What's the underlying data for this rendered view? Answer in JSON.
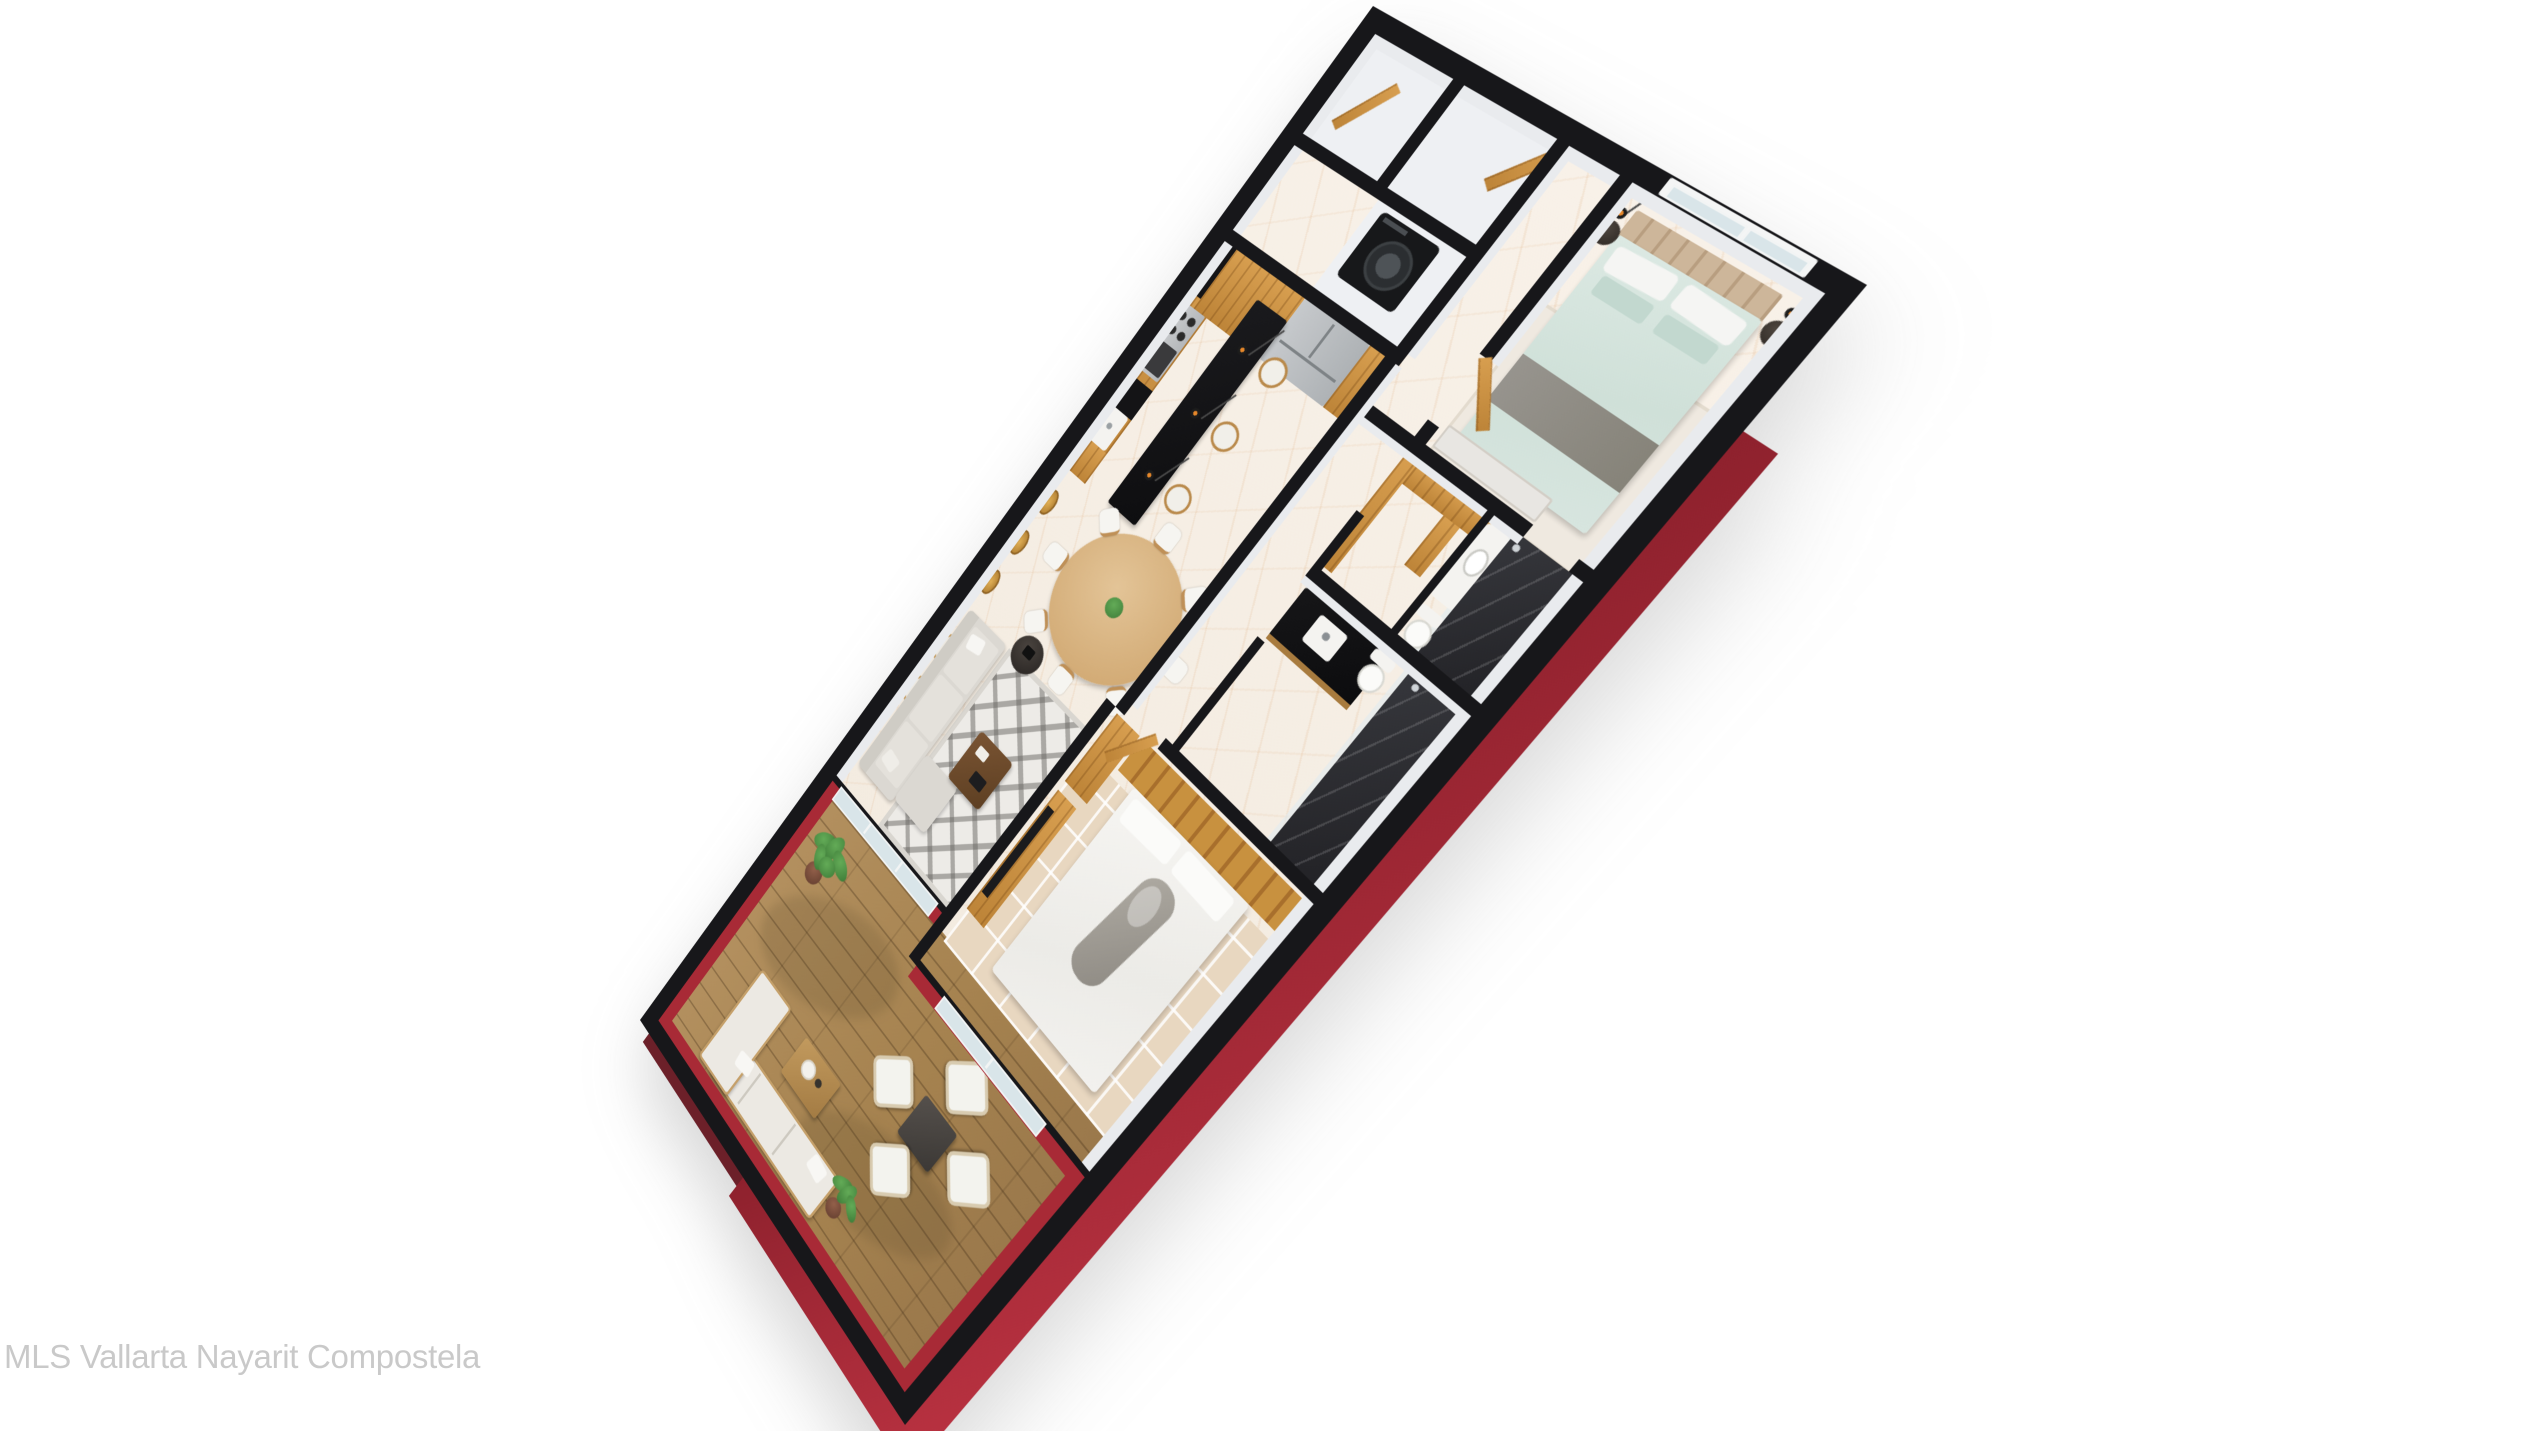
{
  "watermark": {
    "text": "MLS Vallarta Nayarit Compostela"
  },
  "scene": {
    "type": "3d-rendered-floor-plan",
    "description": "Isometric top-down 3D render of a two-bedroom apartment rotated on white background",
    "rooms": [
      "entry-closets",
      "laundry",
      "kitchen",
      "dining-area",
      "living-room",
      "master-bedroom",
      "walk-in-closet",
      "master-bathroom",
      "second-bathroom",
      "second-bedroom",
      "terrace"
    ]
  },
  "palette": {
    "background": "#ffffff",
    "wall_top": "#17171a",
    "wall_face": "#e9ebee",
    "exterior_red": "#b02836",
    "exterior_red_dark": "#8e212d",
    "marble_floor": "#f6efe5",
    "wood": "#c98f41",
    "deck_wood": "#a9875a",
    "dark_marble": "#2e2f33",
    "sofa_gray": "#d9d6d1",
    "bed_master": "#d9e7e1",
    "bed_second": "#f4f3f0",
    "plant_green": "#4a8c41",
    "watermark_gray": "#c9c9c9"
  }
}
